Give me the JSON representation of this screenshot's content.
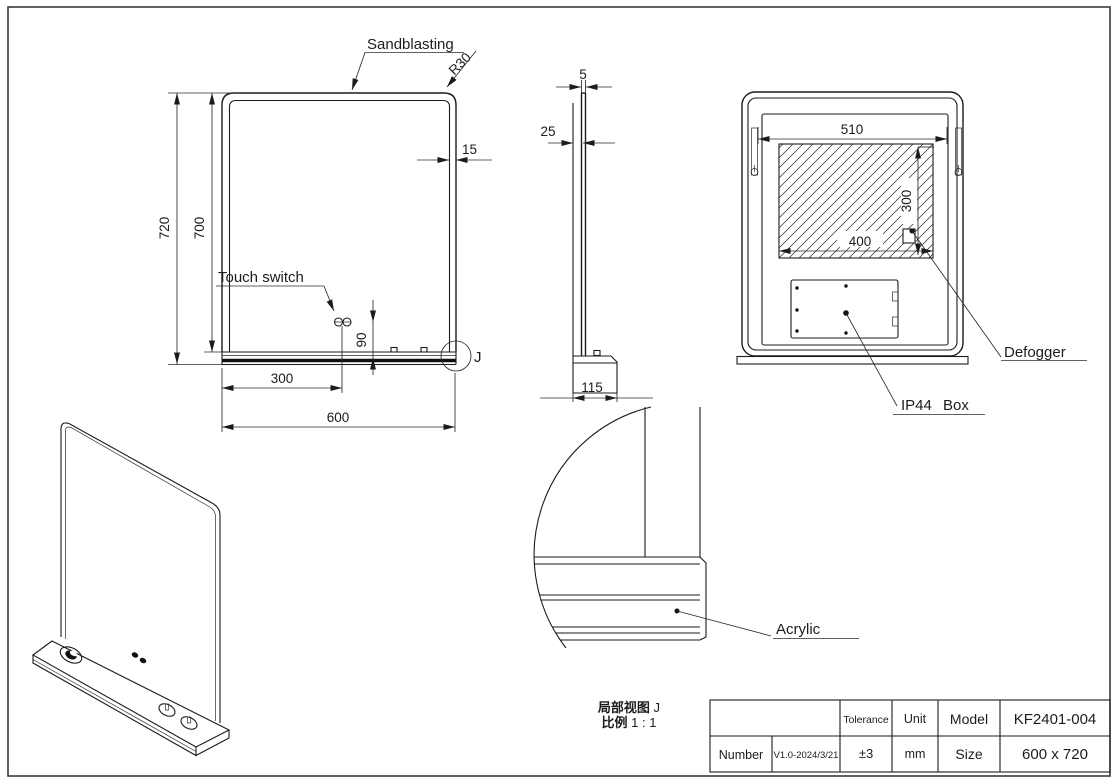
{
  "front_view": {
    "label_sandblasting": "Sandblasting",
    "label_touch_switch": "Touch switch",
    "dim_corner_radius": "R30",
    "dim_border": "15",
    "dim_height_outer": "720",
    "dim_height_inner": "700",
    "dim_switch_height": "90",
    "dim_switch_offset": "300",
    "dim_width": "600",
    "detail_marker": "J"
  },
  "side_view": {
    "dim_glass_thickness": "5",
    "dim_depth": "25",
    "dim_shelf_depth": "115"
  },
  "back_view": {
    "dim_hanger_span": "510",
    "dim_defogger_width": "400",
    "dim_defogger_height": "300",
    "label_defogger": "Defogger",
    "label_ip44_box": "IP44 Box"
  },
  "detail_view": {
    "caption_name": "局部视图",
    "caption_marker": " J",
    "caption_scale_label": "比例",
    "caption_scale_value": " 1 : 1",
    "label_acrylic": "Acrylic"
  },
  "title_block": {
    "tolerance_label": "Tolerance",
    "tolerance_value": "±3",
    "unit_label": "Unit",
    "unit_value": "mm",
    "model_label": "Model",
    "model_value": "KF2401-004",
    "number_label": "Number",
    "number_value": "V1.0-2024/3/21",
    "size_label": "Size",
    "size_value": "600 x 720"
  }
}
